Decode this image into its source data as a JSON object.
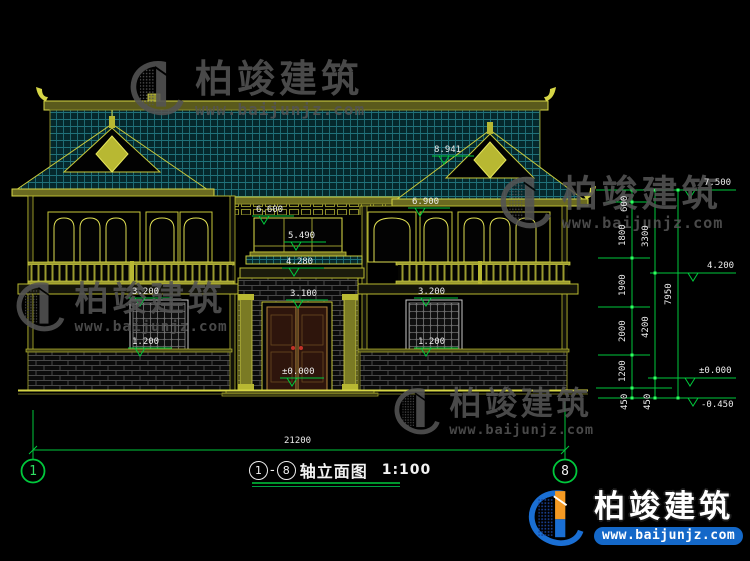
{
  "drawing": {
    "title": {
      "axis_start": "1",
      "separator": "-",
      "axis_end": "8",
      "name": "轴立面图",
      "scale": "1:100"
    },
    "axis_bubbles": {
      "left": "1",
      "right": "8"
    },
    "overall_width_mm": "21200",
    "elevation_markers": {
      "ridge": "8.941",
      "center_eave": "6.600",
      "center_window": "5.490",
      "wing_eave": "6.900",
      "porch_top": "4.280",
      "door_top": "3.100",
      "entry_level": "±0.000",
      "left_window_top": "3.200",
      "left_window_sill": "1.200",
      "right_window_top": "3.200",
      "right_window_sill": "1.200"
    },
    "right_levels": {
      "top": "7.500",
      "mid": "4.200",
      "zero": "±0.000",
      "ground": "-0.450"
    },
    "dim_chain_inner": [
      "600",
      "1800",
      "1900",
      "2000",
      "1200",
      "450"
    ],
    "dim_chain_mid": [
      "3300",
      "4200",
      "450"
    ],
    "dim_overall_height": "7950"
  },
  "watermark": {
    "brand": "柏竣建筑",
    "url": "www.baijunjz.com"
  },
  "colors": {
    "background": "#000000",
    "cad_yellow": "#d6d646",
    "cad_olive": "#b9b92f",
    "tile_teal": "#20717a",
    "dim_green": "#00c83c",
    "text_white": "#ececec",
    "brand_blue": "#1468c8",
    "brand_orange": "#f59a23",
    "door_wood": "#2e150c"
  }
}
